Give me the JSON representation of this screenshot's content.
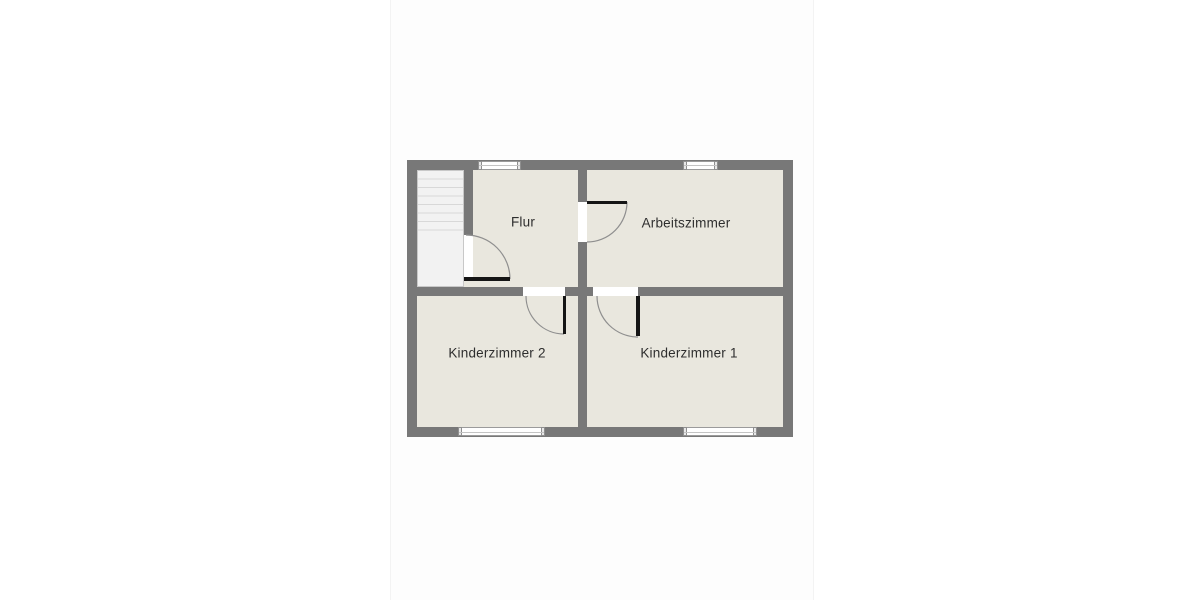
{
  "floor_plan": {
    "rooms": [
      {
        "id": "flur",
        "label": "Flur"
      },
      {
        "id": "arbeitszimmer",
        "label": "Arbeitszimmer"
      },
      {
        "id": "kinderzimmer-2",
        "label": "Kinderzimmer 2"
      },
      {
        "id": "kinderzimmer-1",
        "label": "Kinderzimmer 1"
      }
    ],
    "features": {
      "staircase": "staircase-top-left",
      "door_count": 4,
      "window_count": 4
    },
    "colors": {
      "wall": "#787878",
      "room_fill": "#e9e7de",
      "stair_fill": "#f2f2f2",
      "stair_step_line": "#d8d8d8",
      "door_leaf": "#151515",
      "door_arc": "#8f8f8f",
      "window_fill": "#ffffff",
      "label_text": "#2e2e2e",
      "canvas": "#ffffff",
      "image_band": "#fdfdfd"
    }
  }
}
